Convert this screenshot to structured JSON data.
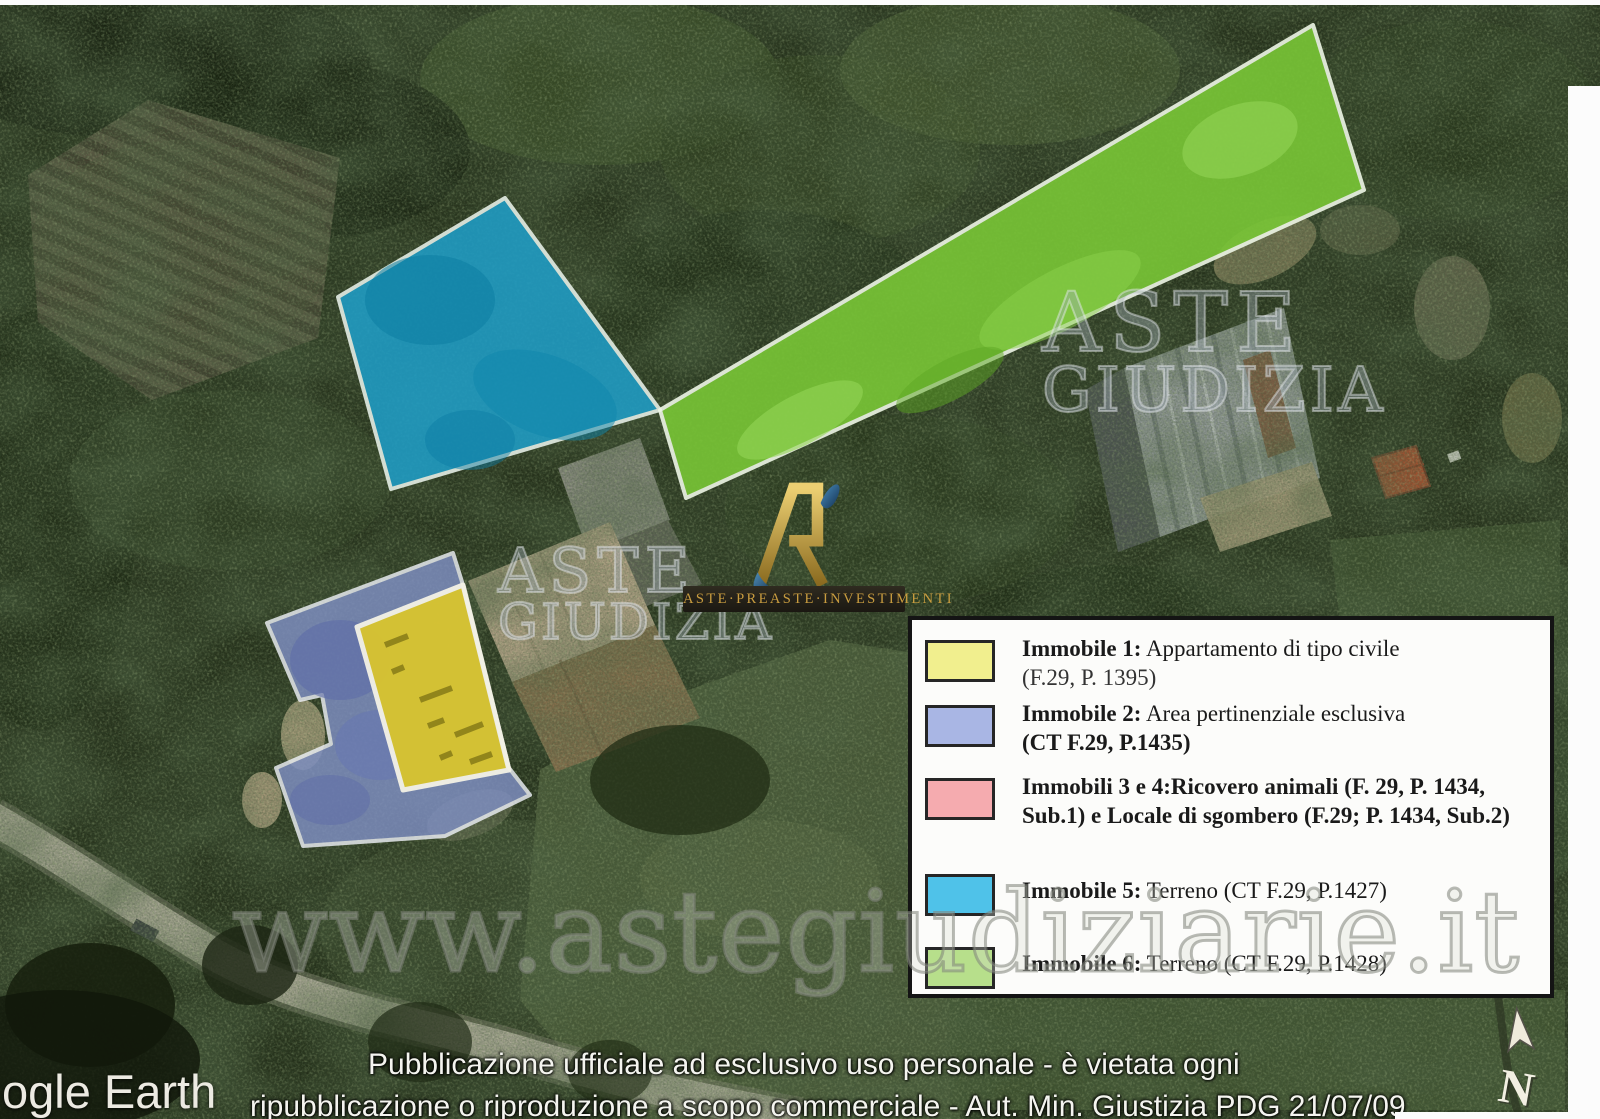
{
  "map": {
    "google_earth_label": "ogle Earth",
    "watermark_large": "www.astegiudiziarie.it",
    "watermark_tile": {
      "line1": "ASTE",
      "line2": "GIUDIZIA"
    },
    "north_label": "N",
    "footer": {
      "line1": "Pubblicazione ufficiale ad esclusivo uso personale - è vietata ogni",
      "line2": "ripubblicazione o riproduzione a scopo commerciale - Aut. Min. Giustizia PDG 21/07/09"
    }
  },
  "logo": {
    "text": "ASTE·PREASTE·INVESTIMENTI"
  },
  "legend": {
    "rows": [
      {
        "label": "Immobile 1:",
        "text": " Appartamento di tipo civile",
        "line2": "(F.29, P. 1395)",
        "swatch": "background:#f1ef8e"
      },
      {
        "label": "Immobile 2:",
        "text": " Area pertinenziale esclusiva",
        "line2": "(CT F.29, P.1435)",
        "swatch": "background:#a9b6e4"
      },
      {
        "label": "Immobili 3 e 4:",
        "text": "Ricovero animali (F. 29, P. 1434, Sub.1) e Locale di sgombero (F.29; P. 1434, Sub.2)",
        "swatch": "background:#f5abaf"
      },
      {
        "label": "Immobile 5:",
        "text": " Terreno (CT F.29, P.1427)",
        "swatch": "background:#4fc2e9"
      },
      {
        "label": "Immobile 6:",
        "text": " Terreno (CT F.29, P.1428)",
        "swatch": "background:#b7df8b"
      }
    ]
  },
  "overlays": {
    "immobile1": {
      "fill": "#d9c52e"
    },
    "immobile2": {
      "fill": "#8090c4"
    },
    "immobile5": {
      "fill": "#1f9dc6"
    },
    "immobile6": {
      "fill": "#79c636"
    }
  }
}
